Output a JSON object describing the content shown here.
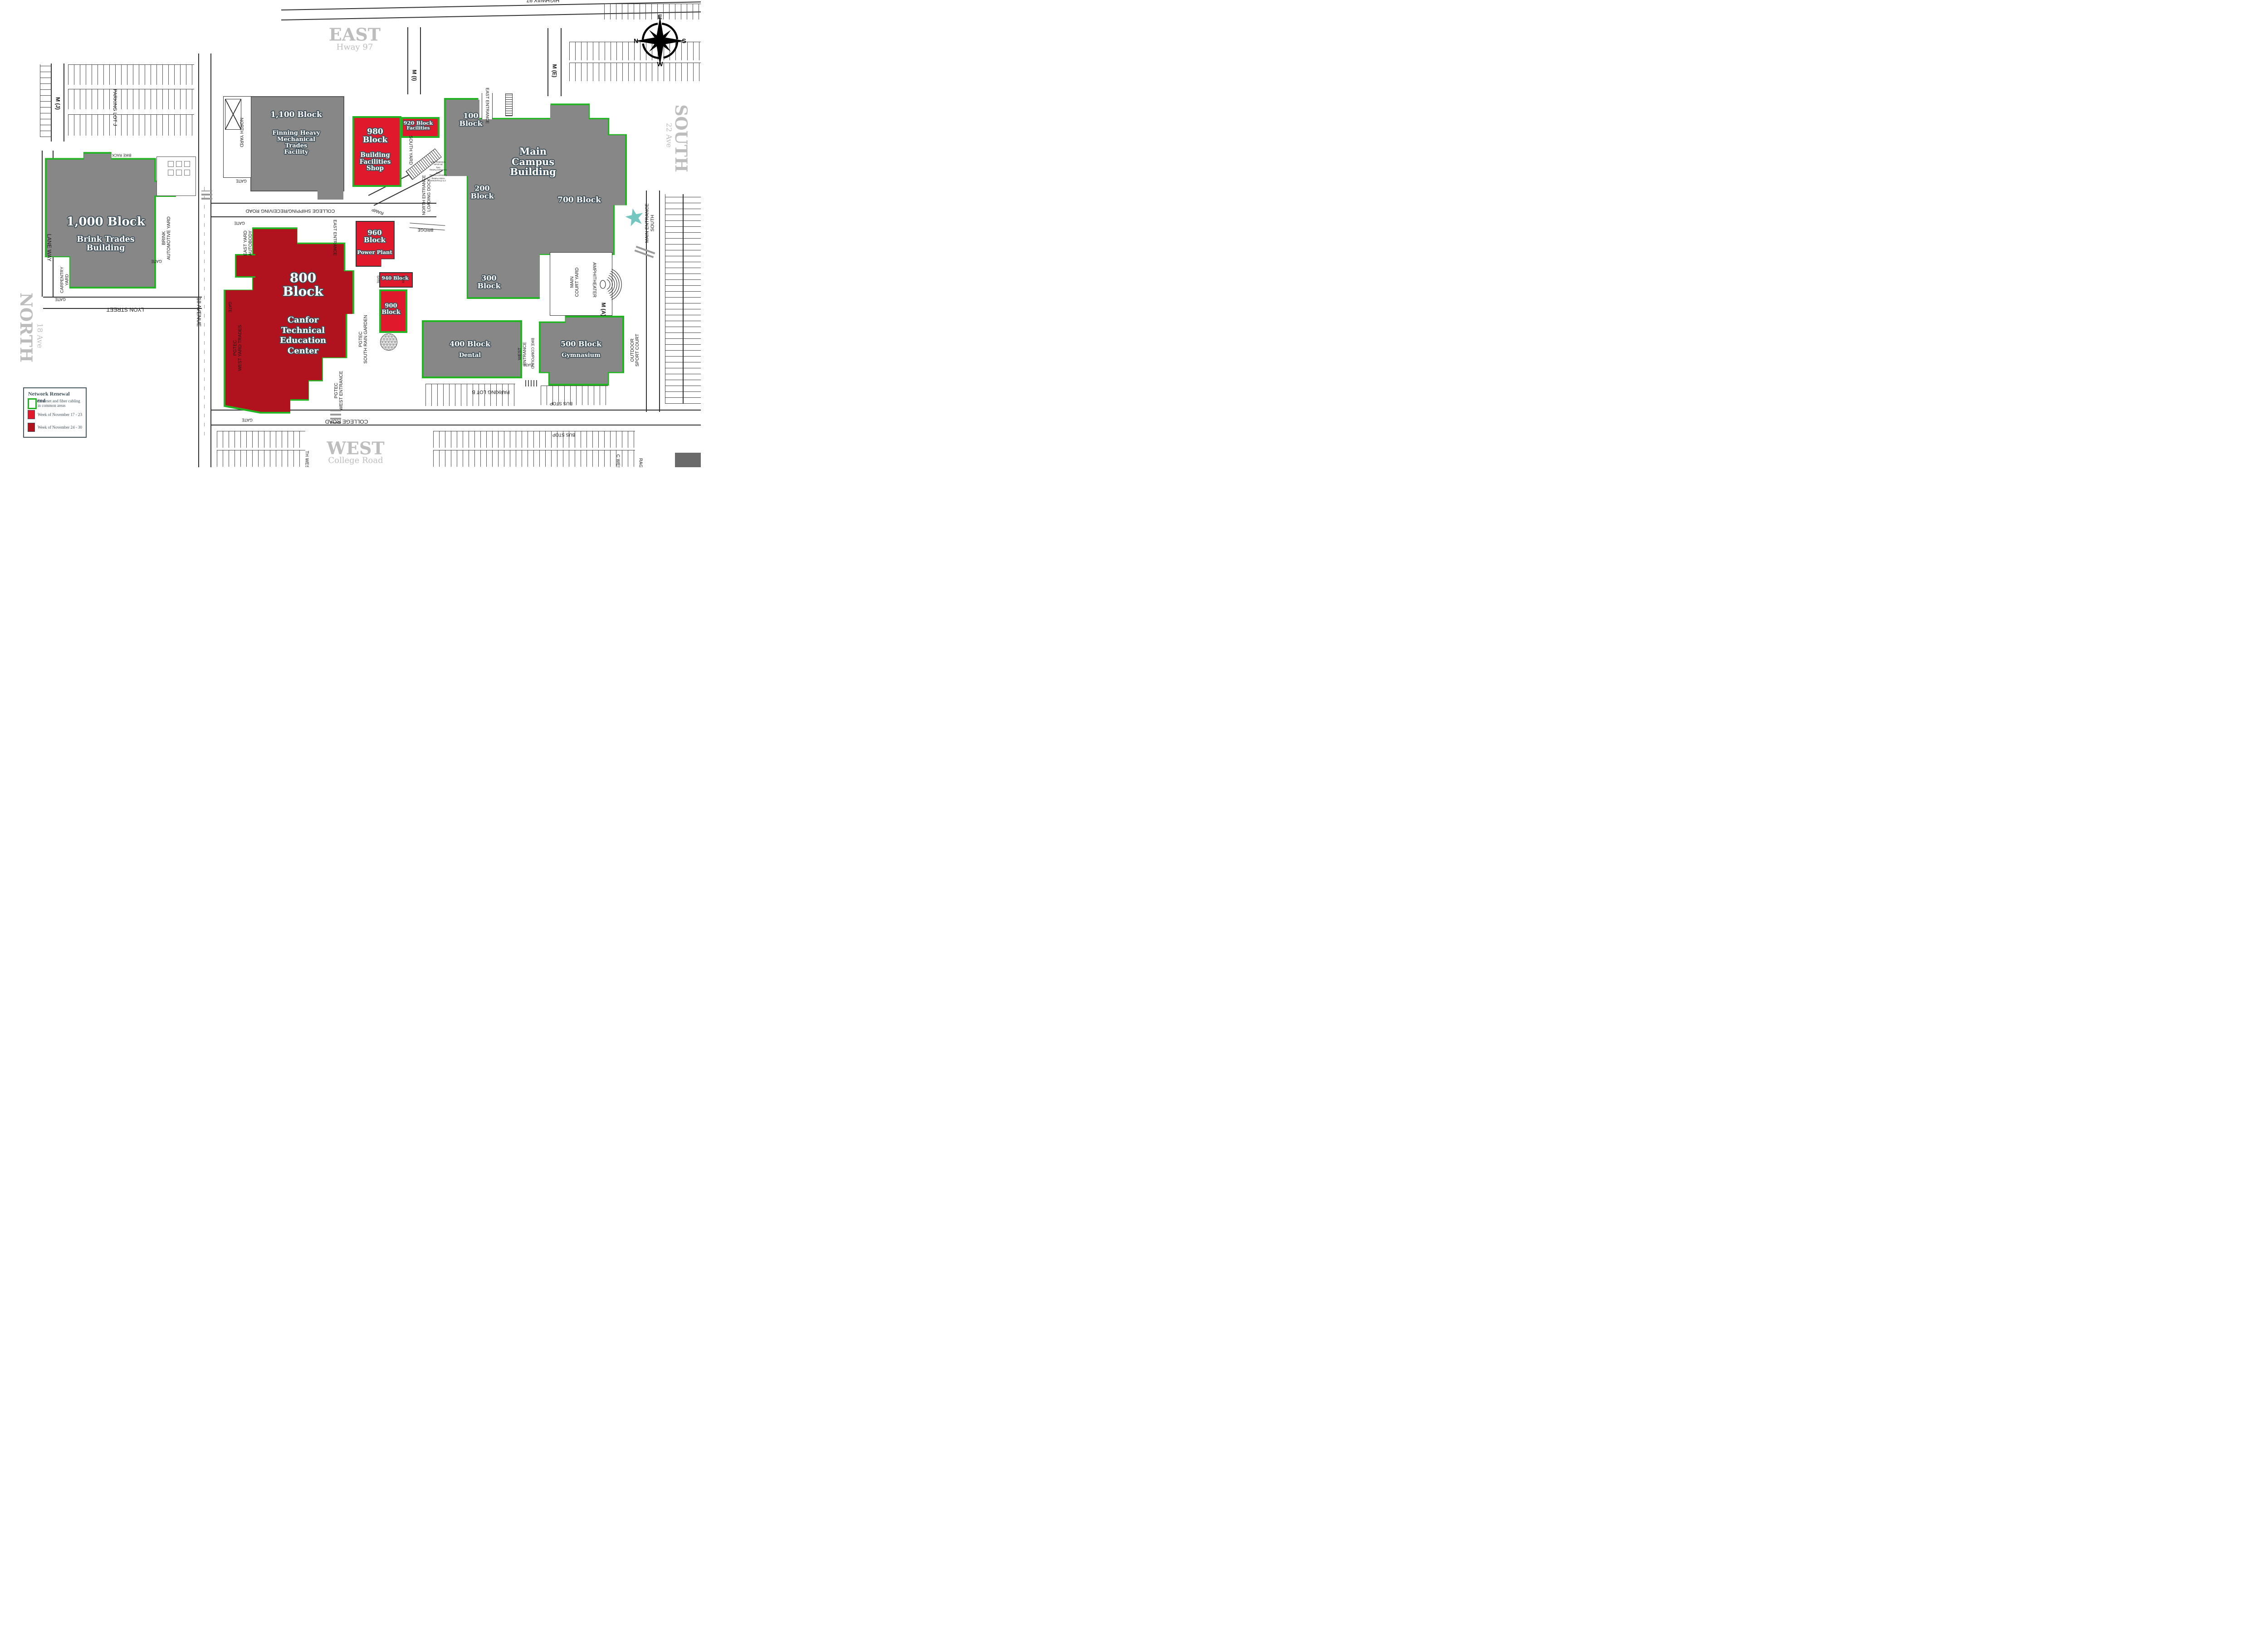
{
  "title": "Campus Network Renewal Map",
  "colors": {
    "building_gray": "#878787",
    "renewal_red": "#E01A2C",
    "renewal_dark_red": "#B0121E",
    "cabling_green": "#22B422",
    "star_teal": "#74C7C0",
    "label_outline": "#3E505A",
    "region_gray": "#BDBDBD"
  },
  "legend": {
    "title": "Network Renewal Legend",
    "items": [
      {
        "swatch": "green-outline",
        "label": "Ethernet and fiber cabling\nin common areas"
      },
      {
        "swatch": "red",
        "label": "Week of November 17 - 23"
      },
      {
        "swatch": "dark-red",
        "label": "Week of November 24 - 30"
      }
    ]
  },
  "compass": {
    "top": "E",
    "right": "S",
    "bottom": "W",
    "left": "N"
  },
  "regions": {
    "east": {
      "title": "EAST",
      "subtitle": "Hway 97"
    },
    "south": {
      "title": "SOUTH",
      "subtitle": "22 Ave"
    },
    "north": {
      "title": "NORTH",
      "subtitle": "18 Ave"
    },
    "west": {
      "title": "WEST",
      "subtitle": "College Road"
    }
  },
  "buildings": {
    "b1100": {
      "title": "1,100 Block",
      "desc": "Finning Heavy\nMechanical\nTrades\nFacility",
      "fill": "gray"
    },
    "b980": {
      "title": "980\nBlock",
      "desc": "Building\nFacilities\nShop",
      "fill": "red",
      "outline": "green"
    },
    "b920": {
      "title": "920 Block",
      "desc": "Facilities",
      "fill": "red",
      "outline": "green"
    },
    "c100": {
      "title": "100\nBlock"
    },
    "cmain": {
      "title": "Main\nCampus\nBuilding"
    },
    "c200": {
      "title": "200\nBlock"
    },
    "c700": {
      "title": "700 Block"
    },
    "c300": {
      "title": "300\nBlock"
    },
    "b1000": {
      "title": "1,000 Block",
      "desc": "Brink Trades\nBuilding",
      "fill": "gray",
      "outline": "green"
    },
    "b800": {
      "title": "800\nBlock",
      "desc": "Canfor\nTechnical\nEducation\nCenter",
      "fill": "dark-red",
      "outline": "green"
    },
    "b960": {
      "title": "960\nBlock",
      "desc": "Power Plant",
      "fill": "red"
    },
    "b940": {
      "title": "940 Block",
      "fill": "red"
    },
    "b900": {
      "title": "900\nBlock",
      "fill": "red",
      "outline": "green"
    },
    "b400": {
      "title": "400 Block",
      "desc": "Dental",
      "fill": "gray",
      "outline": "green"
    },
    "b500": {
      "title": "500 Block",
      "desc": "Gymnasium",
      "fill": "gray",
      "outline": "green"
    }
  },
  "labels": {
    "m_j": "M (J)",
    "parking_lot_j": "PARKING LOT J",
    "bike_rack": "BIKE RACK",
    "north_yard": "NORTH YARD",
    "gate": "GATE",
    "m_i": "M (I)",
    "m_e": "M (E)",
    "m_a": "M (A)",
    "east_entrance": "EAST ENTRANCE",
    "south_yard": "SOUTH YARD",
    "ramp": "RAMP",
    "north_entrance_loading_dock": "NORTH ENTRANCE\nLOADING DOCK",
    "bridge": "BRIDGE",
    "college_shipping": "COLLEGE SHIPPING/RECEIVING ROAD",
    "east_yard_autobody": "EAST YARD\nAUTOBODY",
    "lane_way": "LANE WAY",
    "carpentry_yard": "CARPENTRY\nYARD",
    "brink_automotive": "BRINK\nAUTOMOTIVE YARD",
    "lyon_street": "LYON STREET",
    "avenue_18": "18 AVENUE",
    "pgtec_west_yard": "PGTEC\nWEST YARD TRADES",
    "pgtec_rain_garden": "PGTEC\nSOUTH RAIN GARDEN",
    "pgtec_west_entrance": "PGTEC\nWEST ENTRANCE",
    "main_entrance_south": "MAIN ENTRANCE\nSOUTH",
    "main_court_yard": "MAIN\nCOURT YARD",
    "amphitheater": "AMPHITHEATER",
    "outdoor_sport_court": "OUTDOOR\nSPORT COURT",
    "west_entrance": "WEST\nENTRANCE",
    "bike_compound": "BIKE COMPOUND",
    "parking_lot_b": "PARKING LOT B",
    "bus_stop": "BUS STOP",
    "college_road": "COLLEGE ROAD",
    "highway97_top": "HIGHWAY 97",
    "cut_th_west": "TH WEST",
    "cut_c_west": "C WEST",
    "cut_rage": "RAGE",
    "mp_unloading": "30 minute\nUnloading Zone",
    "mp_contractor": "Contractor Parking\nOnly",
    "mp_visitor": "1 hr Procurement\nVisitor Parking"
  }
}
